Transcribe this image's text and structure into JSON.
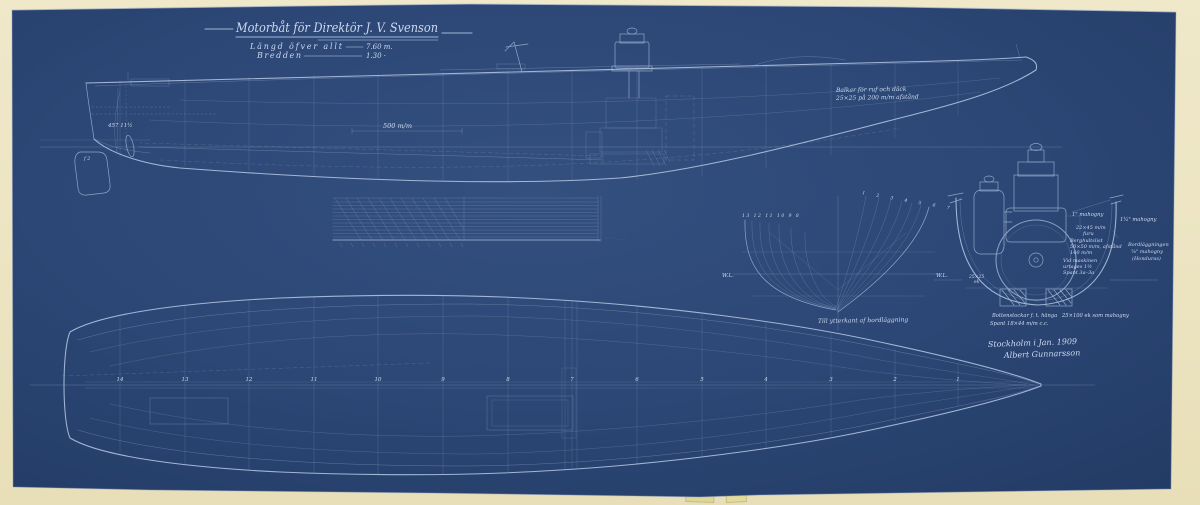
{
  "page": {
    "paper_color": "#ece4c2",
    "sheet_color": "#2c4675",
    "line_color": "#a9bddc",
    "text_color": "#ccd9ef"
  },
  "title_block": {
    "title": "Motorbåt för Direktör J. V. Svenson",
    "loa_label": "Längd öfver allt",
    "loa_value": "7.60 m.",
    "beam_label": "Bredden",
    "beam_value": "1.30 ·"
  },
  "profile": {
    "deck_note_1": "Balkar för ruf och däck",
    "deck_note_2": "25×25 på 200 m/m afstånd",
    "dim_midship": "500 m/m",
    "stern_note": "457 11½",
    "rudder_note": "f 2"
  },
  "body_plan": {
    "caption": "Till ytterkant af bordläggning",
    "wl_left": "W.L.",
    "wl_right": "W.L.",
    "aft_stations": "13 12 11 10 9 8",
    "fwd_stations": "1 2 3 4 5 6 7"
  },
  "engine_section": {
    "note_deck": "1\" mahogny",
    "note_planking_right": "1¼\" mahogny",
    "note_beams_1": "22×45 m/m",
    "note_beams_2": "furu",
    "note_clamp_1": "Berghultslist",
    "note_clamp_2": "50×50 m/m, afstånd",
    "note_clamp_3": "140 m/m",
    "note_engine_1": "Vid maskinen",
    "note_engine_2": "urtages 1½",
    "note_engine_3": "Spant 3a–3a",
    "note_hull_1": "Bordläggningen",
    "note_hull_2": "⅝\" mahogny",
    "note_hull_3": "(Honduras)",
    "note_keel_1": "25×25",
    "note_keel_2": "ek",
    "note_floors_1": "Bottenstockar f. t. hänga",
    "note_floors_2": "25×100 ek som mahogny",
    "note_frames": "Spant 18×44 m/m c.c."
  },
  "plan": {
    "stations": [
      "14",
      "13",
      "12",
      "11",
      "10",
      "9",
      "8",
      "7",
      "6",
      "5",
      "4",
      "3",
      "2",
      "1"
    ]
  },
  "signature": {
    "place_date": "Stockholm i Jan. 1909",
    "name": "Albert Gunnarsson"
  }
}
